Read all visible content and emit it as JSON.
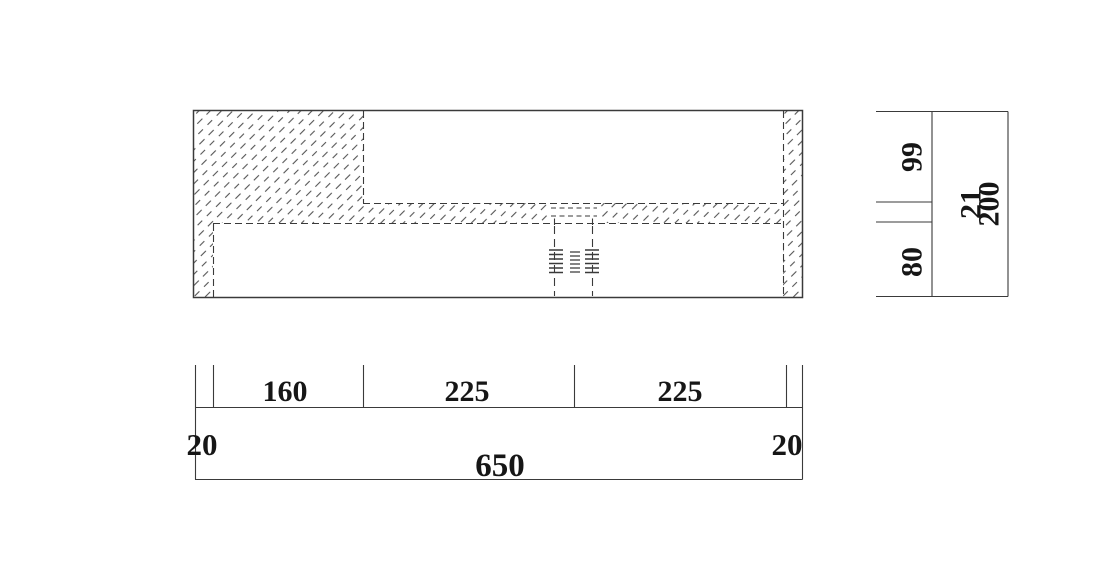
{
  "drawing": {
    "kind": "section-view-with-dimensions"
  },
  "colors": {
    "background": "#ffffff",
    "line": "#3a3a3a",
    "hatch": "#555555",
    "text": "#161616"
  },
  "dimensions": {
    "bottom": {
      "segments": [
        "160",
        "225",
        "225"
      ],
      "left_offset": "20",
      "right_offset": "20",
      "total": "650"
    },
    "right": {
      "upper": "99",
      "gap": "21",
      "lower": "80",
      "total": "200"
    }
  }
}
